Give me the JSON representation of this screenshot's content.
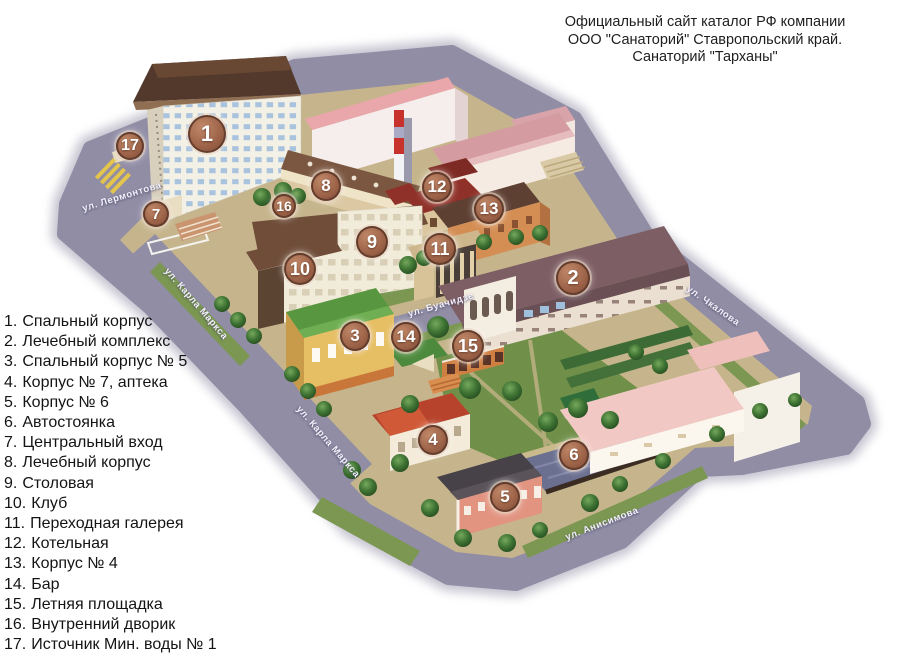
{
  "title": {
    "lines": [
      "Официальный сайт каталог РФ компании",
      "ООО \"Санаторий\" Ставропольский край.",
      "Санаторий \"Тарханы\""
    ]
  },
  "legend": {
    "items": [
      {
        "number": "1.",
        "label": "Спальный корпус"
      },
      {
        "number": "2.",
        "label": "Лечебный комплекс"
      },
      {
        "number": "3.",
        "label": "Спальный корпус № 5"
      },
      {
        "number": "4.",
        "label": "Корпус № 7, аптека"
      },
      {
        "number": "5.",
        "label": "Корпус № 6"
      },
      {
        "number": "6.",
        "label": "Автостоянка"
      },
      {
        "number": "7.",
        "label": "Центральный вход"
      },
      {
        "number": "8.",
        "label": "Лечебный корпус"
      },
      {
        "number": "9.",
        "label": "Столовая"
      },
      {
        "number": "10.",
        "label": "Клуб"
      },
      {
        "number": "11.",
        "label": "Переходная галерея"
      },
      {
        "number": "12.",
        "label": "Котельная"
      },
      {
        "number": "13.",
        "label": "Корпус № 4"
      },
      {
        "number": "14.",
        "label": "Бар"
      },
      {
        "number": "15.",
        "label": "Летняя площадка"
      },
      {
        "number": "16.",
        "label": "Внутренний дворик"
      },
      {
        "number": "17.",
        "label": "Источник Мин. воды № 1"
      }
    ]
  },
  "map": {
    "markers": [
      {
        "label": "1",
        "x": 207,
        "y": 134,
        "r": 19
      },
      {
        "label": "2",
        "x": 573,
        "y": 278,
        "r": 17
      },
      {
        "label": "3",
        "x": 355,
        "y": 336,
        "r": 15
      },
      {
        "label": "4",
        "x": 433,
        "y": 440,
        "r": 15
      },
      {
        "label": "5",
        "x": 505,
        "y": 497,
        "r": 15
      },
      {
        "label": "6",
        "x": 574,
        "y": 455,
        "r": 15
      },
      {
        "label": "7",
        "x": 156,
        "y": 214,
        "r": 13
      },
      {
        "label": "8",
        "x": 326,
        "y": 186,
        "r": 15
      },
      {
        "label": "9",
        "x": 372,
        "y": 242,
        "r": 16
      },
      {
        "label": "10",
        "x": 300,
        "y": 269,
        "r": 16
      },
      {
        "label": "11",
        "x": 440,
        "y": 249,
        "r": 16
      },
      {
        "label": "12",
        "x": 437,
        "y": 187,
        "r": 15
      },
      {
        "label": "13",
        "x": 489,
        "y": 209,
        "r": 15
      },
      {
        "label": "14",
        "x": 406,
        "y": 337,
        "r": 15
      },
      {
        "label": "15",
        "x": 468,
        "y": 346,
        "r": 16
      },
      {
        "label": "16",
        "x": 284,
        "y": 206,
        "r": 12
      },
      {
        "label": "17",
        "x": 130,
        "y": 146,
        "r": 14
      }
    ],
    "streets": [
      {
        "name": "ул. Лермонтова",
        "x": 122,
        "y": 197,
        "angle": -17
      },
      {
        "name": "ул. Карла Маркса",
        "x": 196,
        "y": 304,
        "angle": 49
      },
      {
        "name": "ул. Карла Маркса",
        "x": 328,
        "y": 442,
        "angle": 49
      },
      {
        "name": "ул. Буачидзе",
        "x": 441,
        "y": 305,
        "angle": -16
      },
      {
        "name": "ул. Чкалова",
        "x": 713,
        "y": 306,
        "angle": 35
      },
      {
        "name": "ул. Анисимова",
        "x": 602,
        "y": 524,
        "angle": -21
      }
    ],
    "colors": {
      "marker": "#a9735a",
      "street": "#908da5",
      "grass": "#7b9751",
      "park": "#70904a",
      "ground": "#c6b58c"
    }
  }
}
